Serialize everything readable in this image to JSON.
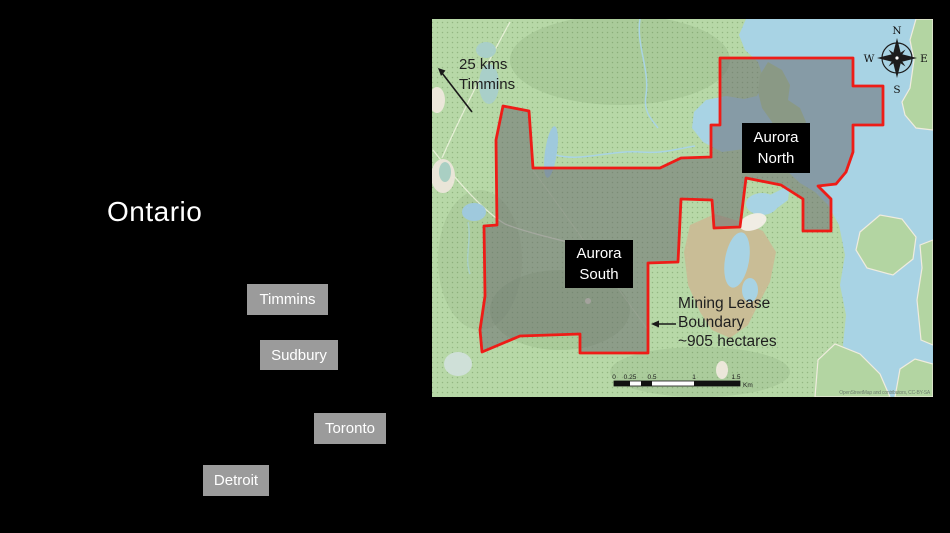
{
  "left_panel": {
    "region_label": "Ontario",
    "cities": [
      "Timmins",
      "Sudbury",
      "Toronto",
      "Detroit"
    ]
  },
  "map": {
    "distance_note": {
      "line1": "25 kms",
      "line2": "Timmins"
    },
    "labels": {
      "aurora_north": {
        "line1": "Aurora",
        "line2": "North"
      },
      "aurora_south": {
        "line1": "Aurora",
        "line2": "South"
      }
    },
    "lease_note": {
      "line1": "Mining Lease",
      "line2": "Boundary",
      "line3": "~905 hectares"
    },
    "compass": {
      "north": "N",
      "east": "E",
      "south": "S",
      "west": "W"
    },
    "scale_bar": {
      "ticks": [
        "0",
        "0.25",
        "0.5",
        "1",
        "1.5"
      ],
      "unit": "Km"
    },
    "attribution": "OpenStreetMap and contributors, CC-BY-SA",
    "colors": {
      "land_green": "#b7d8a7",
      "water_blue": "#a8d3e4",
      "lease_boundary_red": "#ee1c17",
      "lease_fill_gray": "#8f9b89",
      "wetland_tan": "#c9bd96",
      "city_badge_gray": "#9b9b9b",
      "label_box_black": "#000000"
    }
  }
}
